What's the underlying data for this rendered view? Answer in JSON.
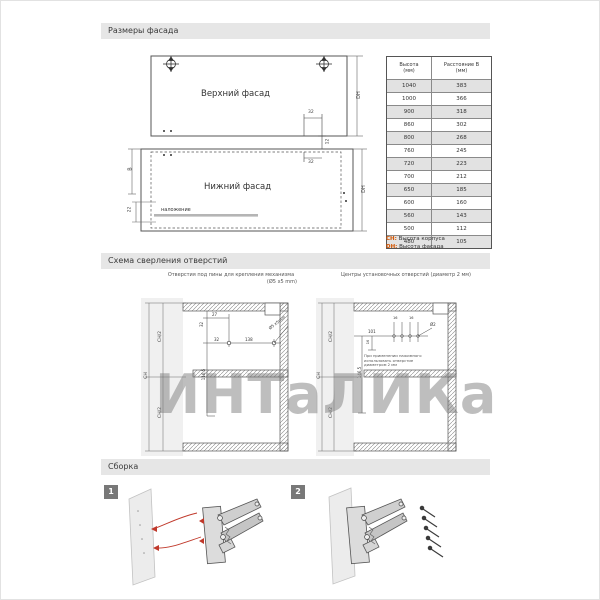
{
  "sections": {
    "facade": "Размеры фасада",
    "drilling": "Схема сверления отверстий",
    "assembly": "Сборка"
  },
  "facade": {
    "upper_label": "Верхний фасад",
    "lower_label": "Нижний фасад",
    "overlap_label": "наложение",
    "dh": "DH",
    "b": "B",
    "d32": "32",
    "d12": "12",
    "d22": "22"
  },
  "table": {
    "col1_title": "Высота",
    "col1_unit": "(мм)",
    "col2_title": "Расстояние B",
    "col2_unit": "(мм)",
    "rows": [
      [
        "1040",
        "383"
      ],
      [
        "1000",
        "366"
      ],
      [
        "900",
        "318"
      ],
      [
        "860",
        "302"
      ],
      [
        "800",
        "268"
      ],
      [
        "760",
        "245"
      ],
      [
        "720",
        "223"
      ],
      [
        "700",
        "212"
      ],
      [
        "650",
        "185"
      ],
      [
        "600",
        "160"
      ],
      [
        "560",
        "143"
      ],
      [
        "500",
        "112"
      ],
      [
        "480",
        "105"
      ]
    ]
  },
  "legend": {
    "ch_key": "CH:",
    "ch_text": "Высота корпуса",
    "dh_key": "DH:",
    "dh_text": "Высота фасада"
  },
  "drilling": {
    "left_caption_1": "Отверстия под пины для крепления механизма",
    "left_caption_2": "(Ø5 х5 mm)",
    "right_caption": "Центры установочных отверстий (диаметр 2 мм)",
    "left": {
      "ch": "CH",
      "ch2": "CH/2",
      "d27": "27",
      "d32v": "32",
      "d116": "116,5",
      "d32h": "32",
      "d138": "138",
      "callout": "Ø5 х5mm"
    },
    "right": {
      "ch": "CH",
      "ch2": "CH/2",
      "d101": "101",
      "d16": "16",
      "d146": "146,5",
      "d16a": "16",
      "d16b": "16",
      "callout": "Ø2",
      "note1": "При применении нажимного",
      "note2": "использовать отверстие",
      "note3": "диаметром 2 мм"
    }
  },
  "assembly": {
    "step1": "1",
    "step2": "2"
  },
  "watermark": {
    "text": "ИНТаЛИКа"
  }
}
